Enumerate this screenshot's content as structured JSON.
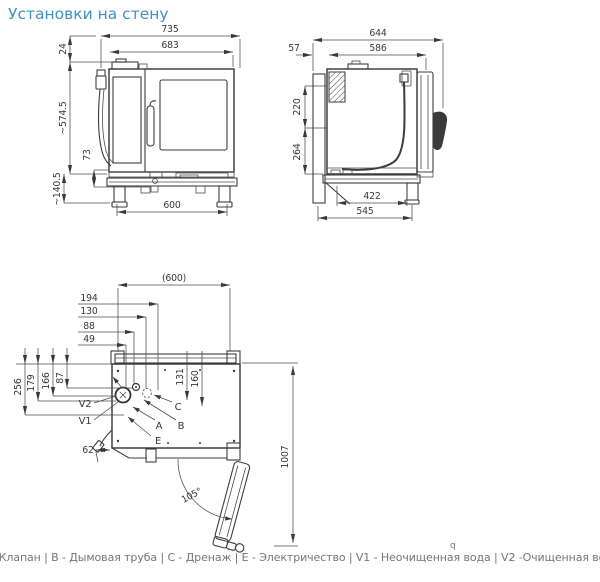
{
  "title": "Установки на стену",
  "front_view": {
    "dims": {
      "total_width": "735",
      "body_width": "683",
      "top_offset": "24",
      "total_height": "~574.5",
      "drain_height": "73",
      "stand_height": "~140.5",
      "leg_span": "600"
    }
  },
  "side_view": {
    "dims": {
      "total_depth": "644",
      "body_depth": "586",
      "wall_gap": "57",
      "upper_height": "220",
      "lower_height": "264",
      "frame_depth": "422",
      "base_depth": "545"
    }
  },
  "top_view": {
    "dims": {
      "width_ref": "(600)",
      "conn_194": "194",
      "conn_130": "130",
      "conn_88": "88",
      "conn_49": "49",
      "left_256": "256",
      "left_179": "179",
      "left_166": "166",
      "left_87": "87",
      "hose_62": "62",
      "rail_131": "131",
      "rail_160": "160",
      "door_angle": "105°",
      "door_clearance": "1007"
    },
    "labels": {
      "v2": "V2",
      "v1": "V1",
      "a": "A",
      "b": "B",
      "c": "C",
      "e": "E"
    }
  },
  "footnote": "q",
  "legend": {
    "line": "A - Клапан | B - Дымовая труба | C - Дренаж | E - Электричество | V1 - Неочищенная вода | V2 -Очищенная вода",
    "items": [
      {
        "code": "A",
        "label": "Клапан"
      },
      {
        "code": "B",
        "label": "Дымовая труба"
      },
      {
        "code": "C",
        "label": "Дренаж"
      },
      {
        "code": "E",
        "label": "Электричество"
      },
      {
        "code": "V1",
        "label": "Неочищенная вода"
      },
      {
        "code": "V2",
        "label": "Очищенная вода"
      }
    ]
  }
}
